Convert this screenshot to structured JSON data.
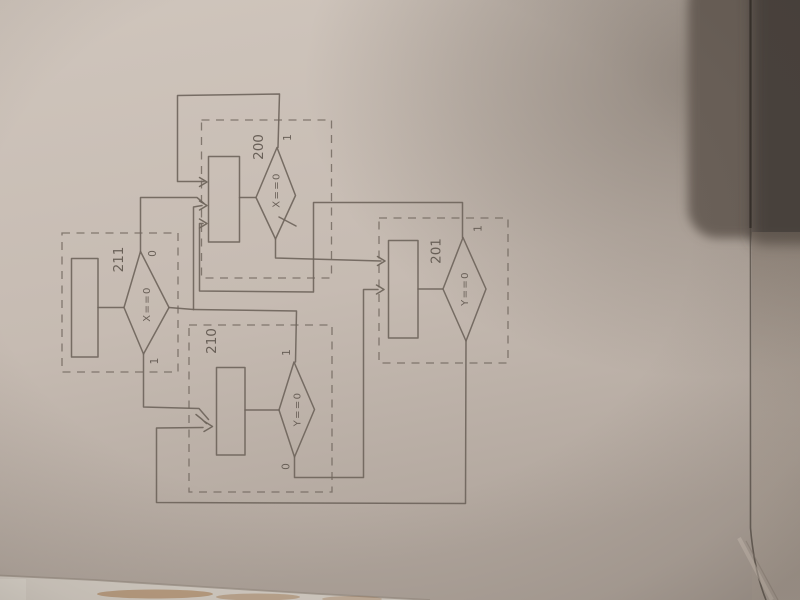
{
  "colors": {
    "paper": "#c8beb5",
    "pencil": "#6f655c",
    "handwriting": "#5f564e",
    "dark_object": "#564e47"
  },
  "diagram": {
    "states": {
      "s200": {
        "name": "200",
        "condition": "X==0",
        "branch_top": "1"
      },
      "s211": {
        "name": "211",
        "condition": "X==0",
        "branch_top": "0",
        "branch_bottom": "1"
      },
      "s210": {
        "name": "210",
        "condition": "Y==0",
        "branch_top": "1",
        "branch_bottom": "0"
      },
      "s201": {
        "name": "201",
        "condition": "Y==0",
        "branch_top": "1"
      }
    }
  }
}
